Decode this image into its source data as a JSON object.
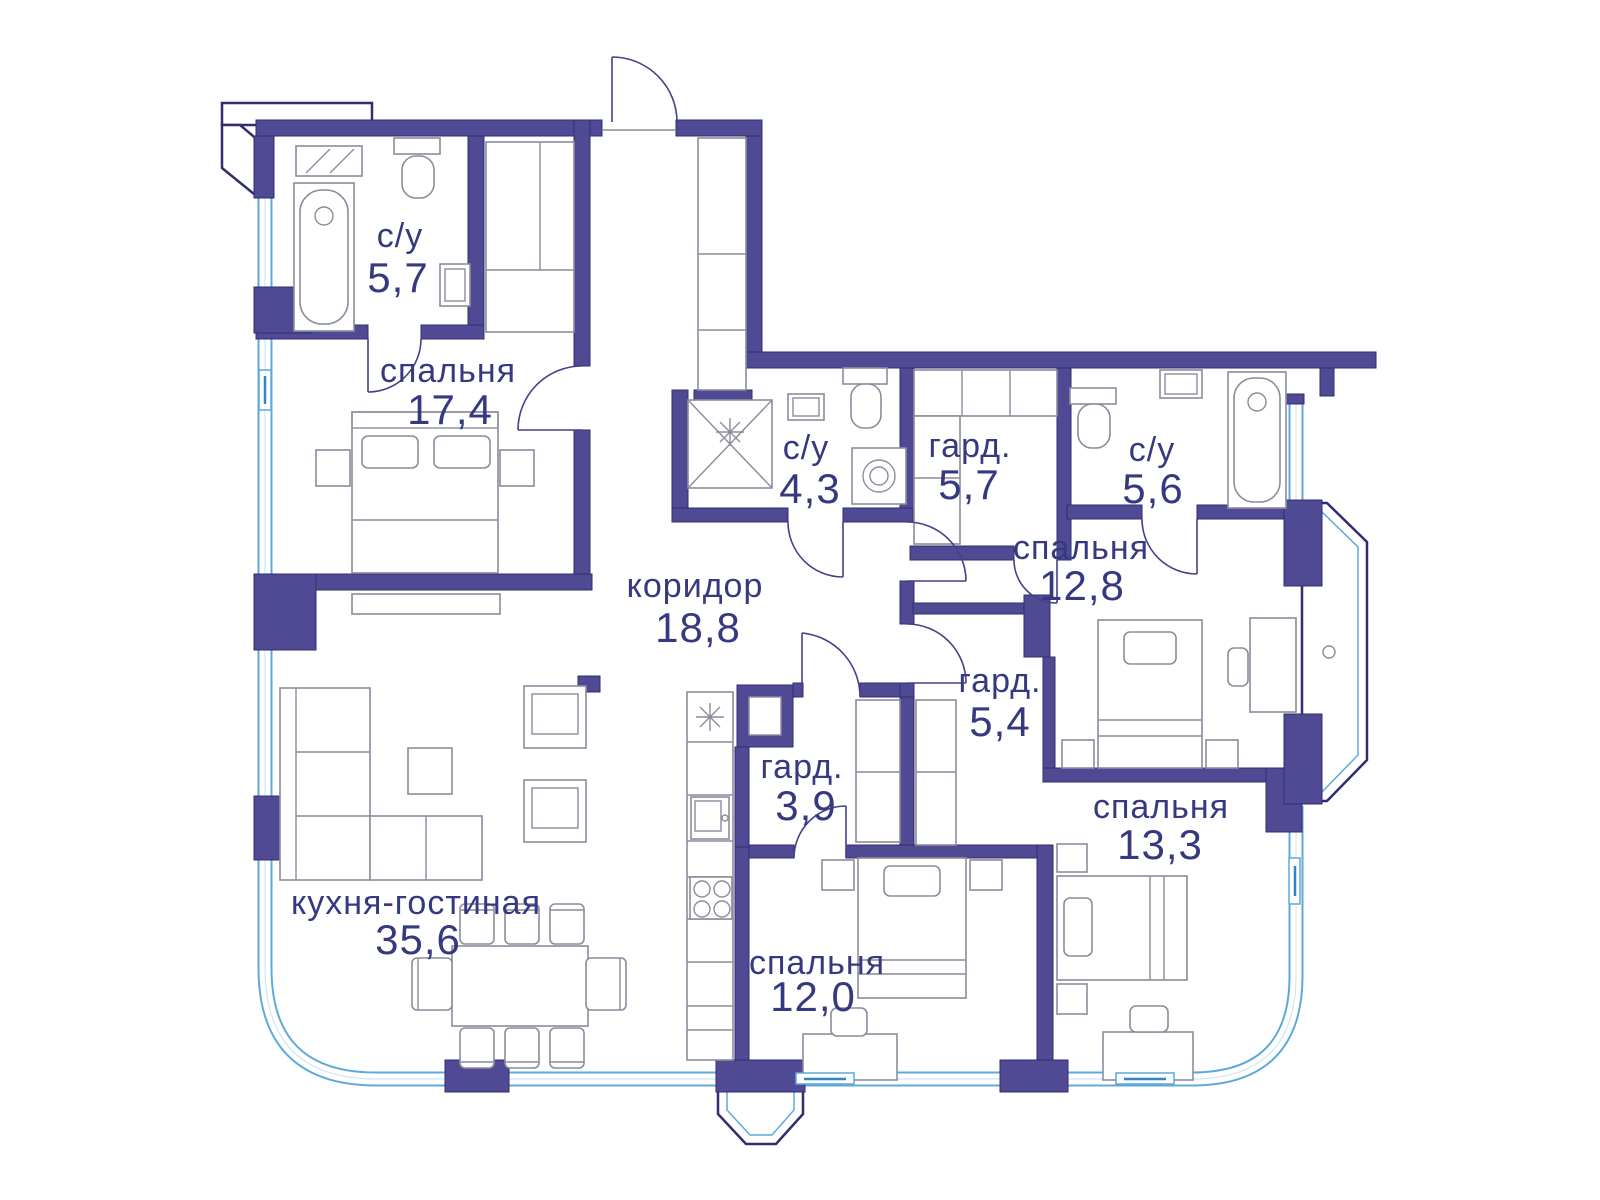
{
  "plan_title": "Floor plan of apartment",
  "palette": {
    "bg": "#ffffff",
    "wall": "#4f4a93",
    "wall_edge": "#322d6f",
    "window": "#5fa9d9",
    "window_dark": "#2e86c8",
    "furniture": "#8c8c9c",
    "door": "#45408a",
    "text": "#353a80"
  },
  "rooms": [
    {
      "id": "bathroom-1",
      "name": "с/у",
      "area": "5,7"
    },
    {
      "id": "bedroom-1",
      "name": "спальня",
      "area": "17,4"
    },
    {
      "id": "bathroom-2",
      "name": "с/у",
      "area": "4,3"
    },
    {
      "id": "wardrobe-1",
      "name": "гард.",
      "area": "5,7"
    },
    {
      "id": "bathroom-3",
      "name": "с/у",
      "area": "5,6"
    },
    {
      "id": "bedroom-2",
      "name": "спальня",
      "area": "12,8"
    },
    {
      "id": "corridor",
      "name": "коридор",
      "area": "18,8"
    },
    {
      "id": "wardrobe-2",
      "name": "гард.",
      "area": "5,4"
    },
    {
      "id": "wardrobe-3",
      "name": "гард.",
      "area": "3,9"
    },
    {
      "id": "bedroom-3",
      "name": "спальня",
      "area": "13,3"
    },
    {
      "id": "kitchen-living",
      "name": "кухня-гостиная",
      "area": "35,6"
    },
    {
      "id": "bedroom-4",
      "name": "спальня",
      "area": "12,0"
    }
  ]
}
